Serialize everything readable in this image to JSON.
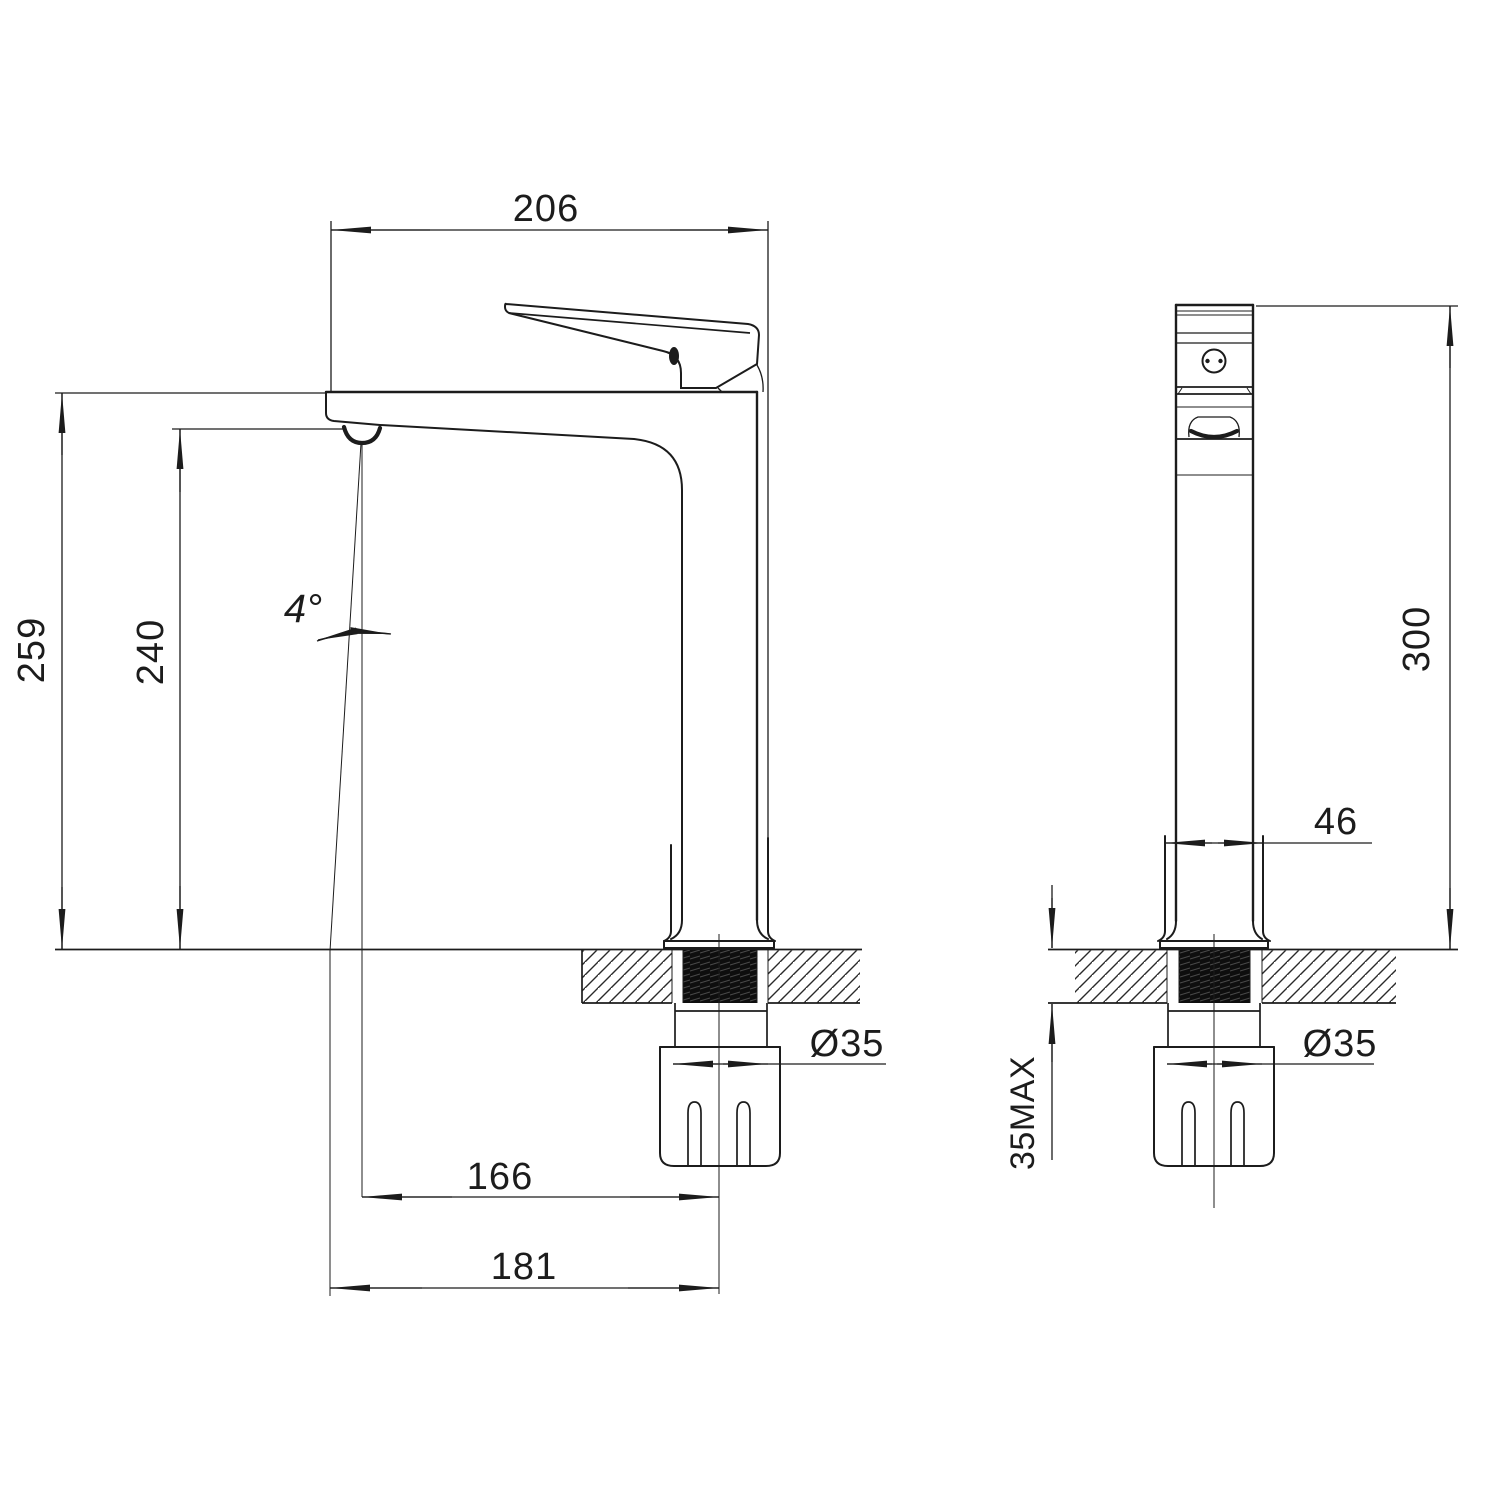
{
  "page": {
    "background": "#ffffff",
    "ink": "#1c1c1c",
    "description": "Technical dimension drawing of a tall single-lever basin mixer tap, front and side elevations with countertop mounting section"
  },
  "front_view": {
    "name": "front-elevation",
    "dims": {
      "overall_depth": "206",
      "overall_height": "259",
      "spout_height": "240",
      "spout_angle": "4°",
      "spout_reach": "166",
      "tip_reach": "181",
      "hole_diameter": "Ø35"
    }
  },
  "side_view": {
    "name": "side-elevation",
    "dims": {
      "base_width": "46",
      "overall_height": "300",
      "counter_thickness_max": "35MAX",
      "hole_diameter": "Ø35"
    }
  }
}
